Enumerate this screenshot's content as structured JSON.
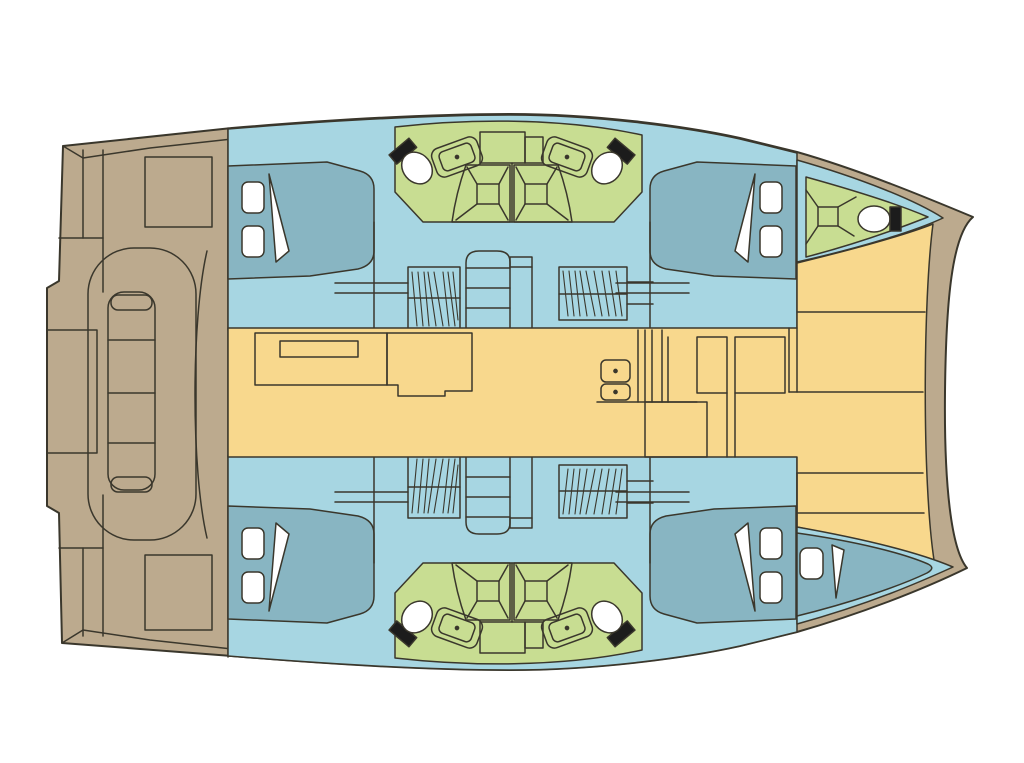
{
  "title": "catamaran-floor-plan",
  "palette": {
    "background": "#ffffff",
    "outline": "#3a372c",
    "hull_tan": "#bcaa8e",
    "cabin_blue": "#a7d6e2",
    "bed_blue": "#88b5c2",
    "bath_green": "#c8dd92",
    "deck_yellow": "#f8d88d",
    "fixture_white": "#ffffff",
    "fixture_black": "#1c1c1c"
  },
  "boat": {
    "type": "sailing-catamaran",
    "view": "deck-and-accommodation-plan",
    "sections": {
      "aft_cockpit": [
        "swim-steps",
        "cockpit-table",
        "bench-seats",
        "aft-seats"
      ],
      "port_hull": [
        "aft-double-cabin",
        "two-bathrooms-with-shower",
        "wardrobes",
        "companionway-stairs",
        "forward-double-cabin",
        "bow-bathroom"
      ],
      "starboard_hull": [
        "aft-double-cabin",
        "two-bathrooms-with-shower",
        "wardrobes",
        "companionway-stairs",
        "forward-double-cabin",
        "bow-berth"
      ],
      "saloon": [
        "settee-console",
        "galley-double-sink",
        "stove",
        "counters",
        "island-unit"
      ],
      "foredeck": [
        "forward-benches",
        "crossbeam"
      ]
    },
    "cabin_count": 4,
    "bathroom_count": 5,
    "berth_extra": 1
  }
}
